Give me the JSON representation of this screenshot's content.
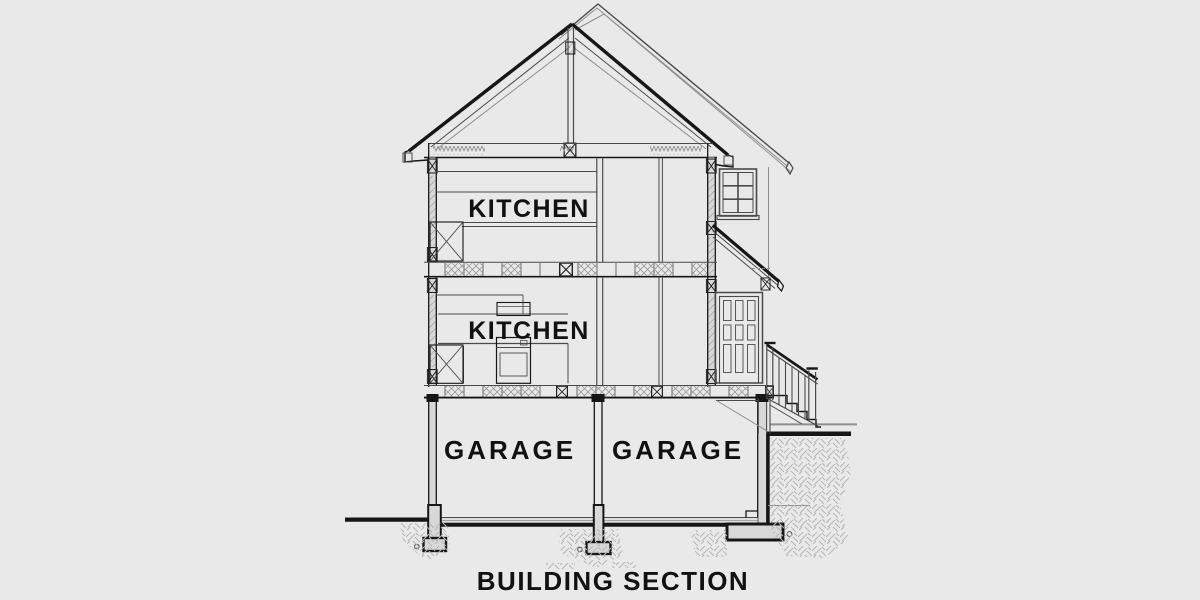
{
  "title": "BUILDING SECTION",
  "rooms": {
    "upper_kitchen": "KITCHEN",
    "main_kitchen": "KITCHEN",
    "garage_left": "GARAGE",
    "garage_right": "GARAGE"
  },
  "colors": {
    "background": "#e9e9e9",
    "line_dark": "#161616",
    "line_mid": "#4a4a4a",
    "line_light": "#8f8f8f",
    "fill_wall": "#d8d8d8",
    "hatch": "#9a9a9a",
    "earth_hatch": "#b5b5b5",
    "text": "#111111"
  }
}
